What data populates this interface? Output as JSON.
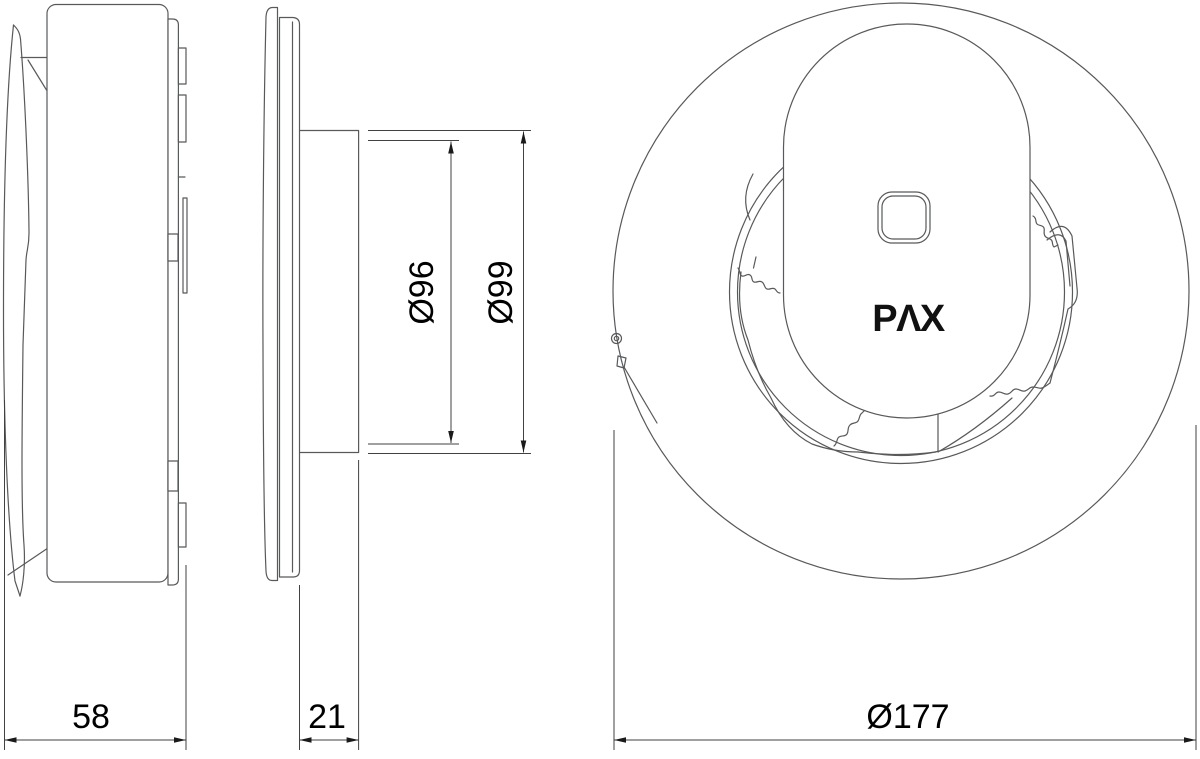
{
  "dimensions": {
    "body_depth": "58",
    "flange_depth": "21",
    "duct_inner_diameter": "Ø96",
    "duct_outer_diameter": "Ø99",
    "front_face_diameter": "Ø177"
  },
  "logo": {
    "text": "PΛX"
  },
  "colors": {
    "background": "#ffffff",
    "outline": "#58595b",
    "dimension_line": "#414042",
    "label_text": "#000000"
  }
}
